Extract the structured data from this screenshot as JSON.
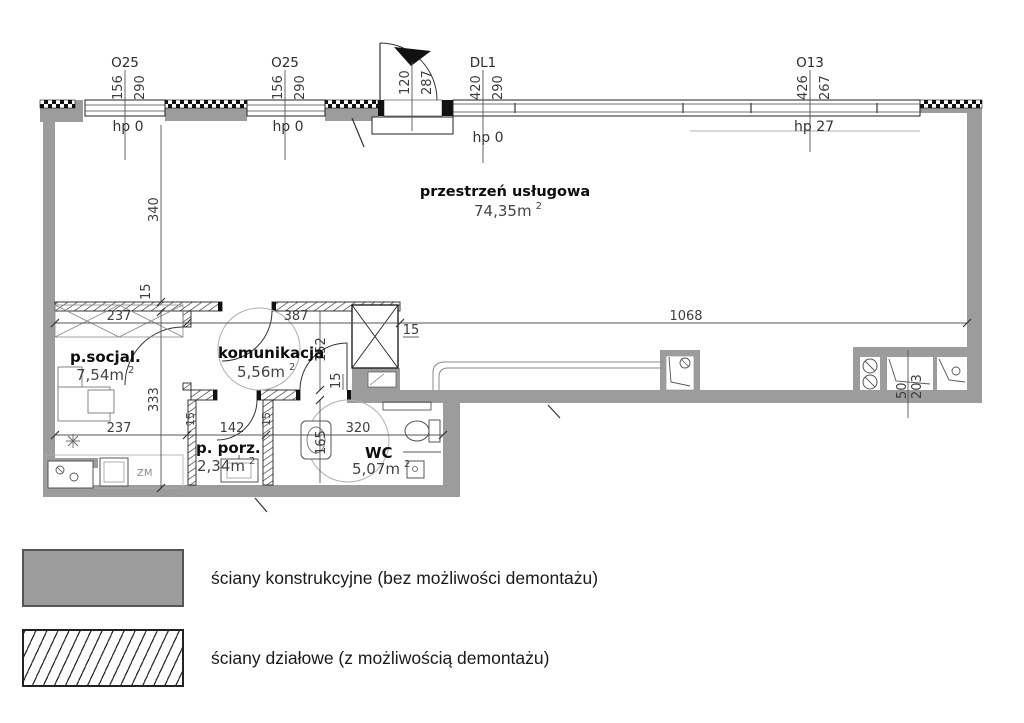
{
  "colors": {
    "wall_gray": "#9c9c9c",
    "line_dark": "#222222",
    "dim_text": "#3d3d3d"
  },
  "plan": {
    "main_room": {
      "name": "przestrzeń usługowa",
      "area": "74,35m",
      "area_sup": "2"
    },
    "rooms": {
      "socjal": {
        "name": "p.socjal.",
        "area": "7,54m",
        "area_sup": "2"
      },
      "komunikacja": {
        "name": "komunikacja",
        "area": "5,56m",
        "area_sup": "2"
      },
      "porz": {
        "name": "p. porz.",
        "area": "2,34m",
        "area_sup": "2"
      },
      "wc": {
        "name": "WC",
        "area": "5,07m",
        "area_sup": "2"
      }
    },
    "openings": {
      "o25_1": {
        "tag": "O25",
        "w": "156",
        "h": "290",
        "hp": "hp 0"
      },
      "o25_2": {
        "tag": "O25",
        "w": "156",
        "h": "290",
        "hp": "hp 0"
      },
      "entry": {
        "w": "120",
        "h": "287"
      },
      "dl1": {
        "tag": "DL1",
        "w": "420",
        "h": "290",
        "hp": "hp 0"
      },
      "o13": {
        "tag": "O13",
        "w": "426",
        "h": "267",
        "hp": "hp 27"
      }
    },
    "dims": {
      "d340": "340",
      "d333": "333",
      "d237": "237",
      "d387": "387",
      "d1068": "1068",
      "d152": "152",
      "d165": "165",
      "d142": "142",
      "d320": "320",
      "d15": "15",
      "d50": "50",
      "d203": "203"
    },
    "labels": {
      "zm": "ZM"
    }
  },
  "legend": {
    "items": [
      {
        "id": "structural",
        "label": "ściany konstrukcyjne (bez możliwości demontażu)"
      },
      {
        "id": "partition",
        "label": "ściany działowe (z możliwością demontażu)"
      }
    ]
  }
}
